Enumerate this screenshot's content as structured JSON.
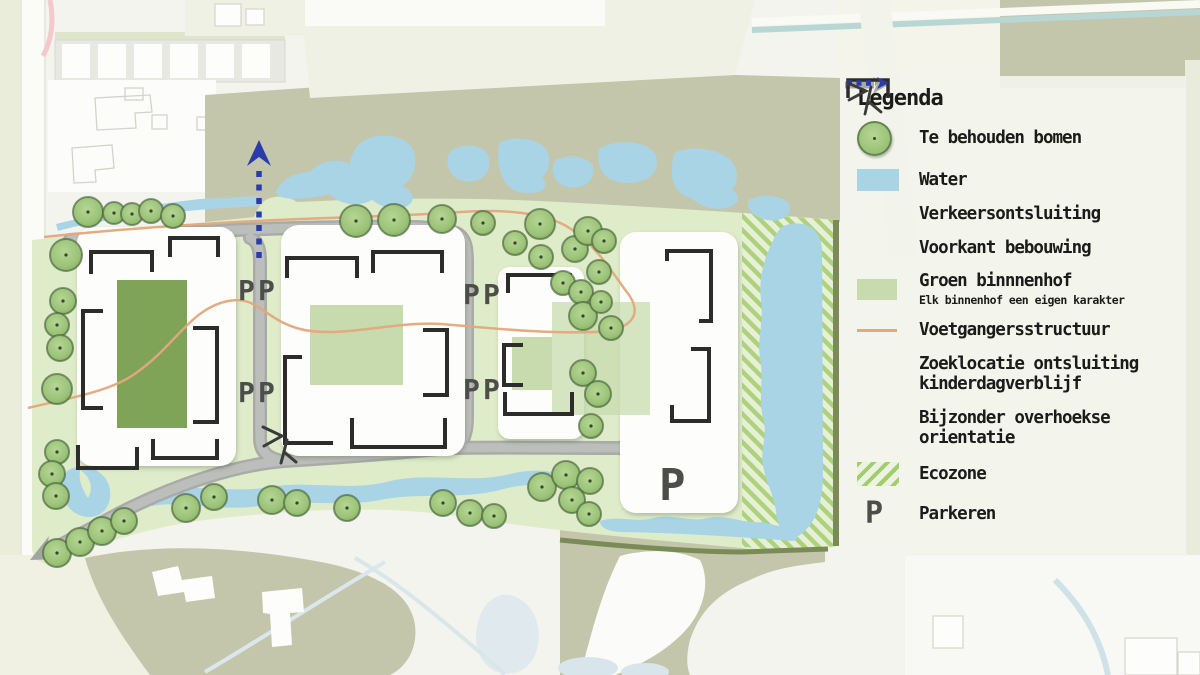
{
  "legend": {
    "title": "Legenda",
    "items": [
      {
        "id": "trees",
        "label": "Te behouden bomen"
      },
      {
        "id": "water",
        "label": "Water"
      },
      {
        "id": "traffic",
        "label": "Verkeersontsluiting"
      },
      {
        "id": "building-front",
        "label": "Voorkant bebouwing"
      },
      {
        "id": "courtyard",
        "label": "Groen binnnenhof",
        "sublabel": "Elk binnenhof een eigen karakter"
      },
      {
        "id": "pedestrian",
        "label": "Voetgangersstructuur"
      },
      {
        "id": "daycare-access",
        "label": "Zoeklocatie ontsluiting kinderdagverblijf"
      },
      {
        "id": "diagonal",
        "label": "Bijzonder overhoekse orientatie"
      },
      {
        "id": "ecozone",
        "label": "Ecozone"
      },
      {
        "id": "parking",
        "label": "Parkeren"
      }
    ]
  },
  "map": {
    "parking_symbol": "P",
    "parking_markers": [
      {
        "x": 238,
        "y": 300,
        "size": 28
      },
      {
        "x": 258,
        "y": 300,
        "size": 28
      },
      {
        "x": 238,
        "y": 402,
        "size": 28
      },
      {
        "x": 258,
        "y": 402,
        "size": 28
      },
      {
        "x": 463,
        "y": 304,
        "size": 28
      },
      {
        "x": 483,
        "y": 304,
        "size": 28
      },
      {
        "x": 463,
        "y": 399,
        "size": 28
      },
      {
        "x": 483,
        "y": 399,
        "size": 28
      },
      {
        "x": 659,
        "y": 500,
        "size": 44
      }
    ],
    "trees": [
      [
        88,
        212,
        15
      ],
      [
        114,
        213,
        11
      ],
      [
        132,
        214,
        11
      ],
      [
        151,
        211,
        12
      ],
      [
        173,
        216,
        12
      ],
      [
        66,
        255,
        16
      ],
      [
        63,
        301,
        13
      ],
      [
        57,
        325,
        12
      ],
      [
        60,
        348,
        13
      ],
      [
        57,
        389,
        15
      ],
      [
        57,
        452,
        12
      ],
      [
        52,
        474,
        13
      ],
      [
        56,
        496,
        13
      ],
      [
        57,
        553,
        14
      ],
      [
        80,
        542,
        14
      ],
      [
        102,
        531,
        14
      ],
      [
        124,
        521,
        13
      ],
      [
        186,
        508,
        14
      ],
      [
        214,
        497,
        13
      ],
      [
        272,
        500,
        14
      ],
      [
        297,
        503,
        13
      ],
      [
        347,
        508,
        13
      ],
      [
        356,
        221,
        16
      ],
      [
        394,
        220,
        16
      ],
      [
        442,
        219,
        14
      ],
      [
        483,
        223,
        12
      ],
      [
        515,
        243,
        12
      ],
      [
        540,
        224,
        15
      ],
      [
        575,
        249,
        13
      ],
      [
        588,
        231,
        14
      ],
      [
        604,
        241,
        12
      ],
      [
        541,
        257,
        12
      ],
      [
        563,
        283,
        12
      ],
      [
        581,
        292,
        12
      ],
      [
        599,
        272,
        12
      ],
      [
        583,
        316,
        14
      ],
      [
        601,
        302,
        11
      ],
      [
        611,
        328,
        12
      ],
      [
        583,
        373,
        13
      ],
      [
        598,
        394,
        13
      ],
      [
        591,
        426,
        12
      ],
      [
        443,
        503,
        13
      ],
      [
        470,
        513,
        13
      ],
      [
        494,
        516,
        12
      ],
      [
        542,
        487,
        14
      ],
      [
        566,
        475,
        14
      ],
      [
        590,
        481,
        13
      ],
      [
        572,
        500,
        13
      ],
      [
        589,
        514,
        12
      ]
    ],
    "colors": {
      "site-green": "#dfecca",
      "water": "#a9d4e6",
      "tree-fill": "#9cc379",
      "road": "#adafac",
      "court-dark": "#7fa458",
      "court-light": "#c7dbae",
      "eco-stripe": "#a3cd6d",
      "path-orange": "#e3a87c",
      "arrow-blue": "#2b3ba9",
      "bracket": "#2c2c2a",
      "olive": "#c3c6ab"
    }
  }
}
